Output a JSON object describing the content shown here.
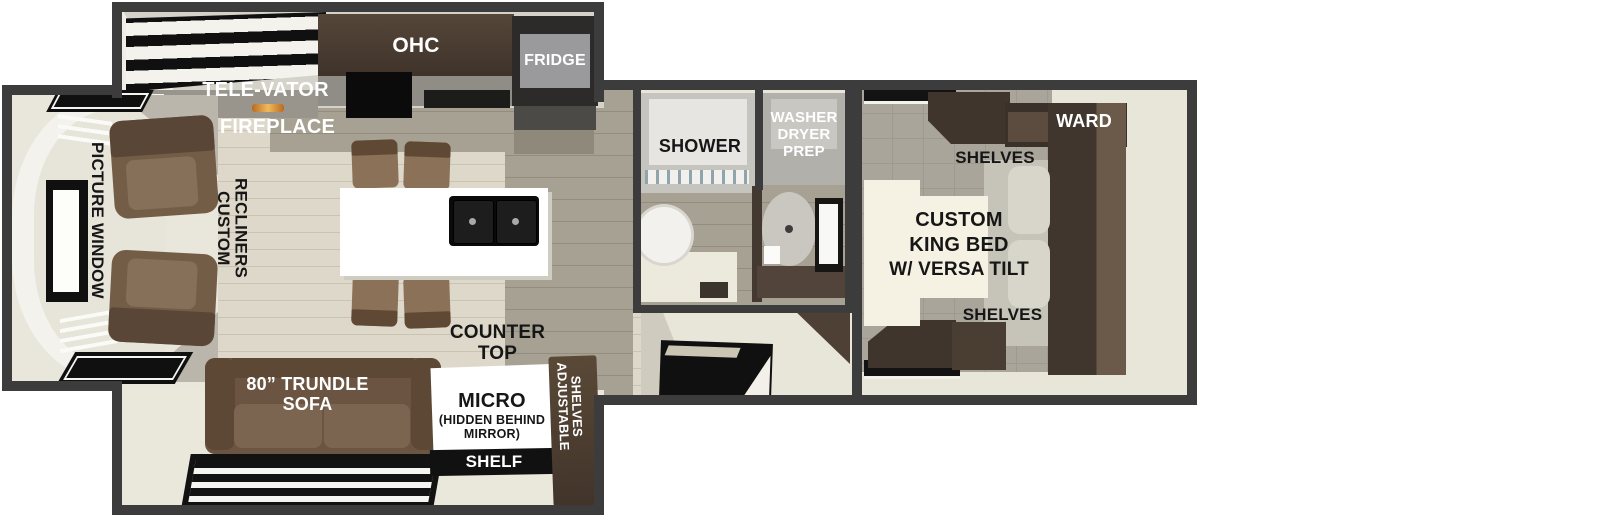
{
  "colors": {
    "wall": "#3c3c3c",
    "floor_cream": "#ddd8c9",
    "floor_kitchen_green": "#a6a193",
    "floor_bedroom_gray": "#a9a59a",
    "cabinet_dark_wood": "#46392f",
    "sofa_brown": "#6b5542",
    "island_white": "#ffffff",
    "appliance_black": "#111111",
    "fireplace_glow": "#e8a13c"
  },
  "labels": {
    "ohc": "OHC",
    "fridge": "FRIDGE",
    "tele_vator": "TELE-VATOR",
    "fireplace": "FIREPLACE",
    "picture_window": "PICTURE WINDOW",
    "custom_recliners": {
      "line1": "CUSTOM",
      "line2": "RECLINERS"
    },
    "counter_top": {
      "line1": "COUNTER",
      "line2": "TOP"
    },
    "trundle_sofa": {
      "line1": "80” TRUNDLE",
      "line2": "SOFA"
    },
    "micro": {
      "line1": "MICRO",
      "line2": "(HIDDEN BEHIND",
      "line3": "MIRROR)"
    },
    "shelf": "SHELF",
    "adjustable_shelves": {
      "line1": "ADJUSTABLE",
      "line2": "SHELVES"
    },
    "shower": "SHOWER",
    "washer_dryer_prep": {
      "line1": "WASHER",
      "line2": "DRYER",
      "line3": "PREP"
    },
    "ward": "WARD",
    "shelves_top": "SHELVES",
    "king_bed": {
      "line1": "CUSTOM",
      "line2": "KING BED",
      "line3": "W/ VERSA TILT"
    },
    "shelves_bottom": "SHELVES"
  }
}
